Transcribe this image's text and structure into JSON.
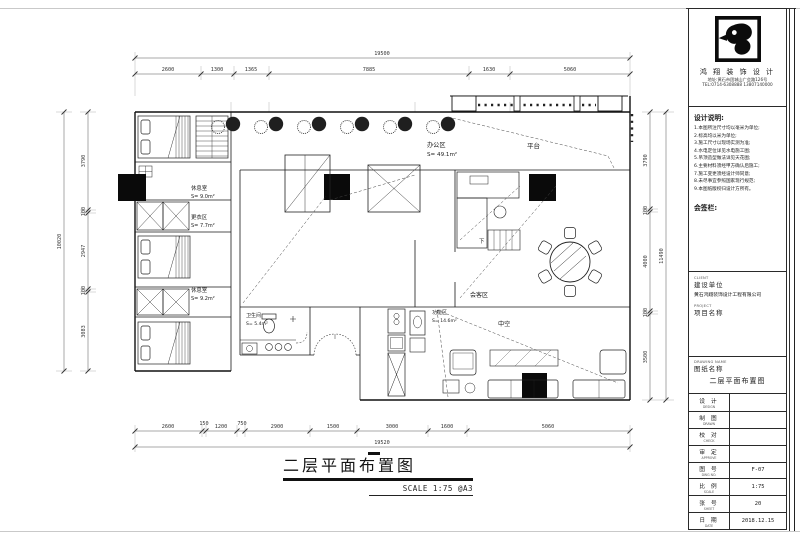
{
  "sheet": {
    "drawing_title": "二层平面布置图",
    "scale_note": "SCALE 1:75 @A3"
  },
  "dims": {
    "top_overall": "19500",
    "top_segments": [
      "2600",
      "1300",
      "1365",
      "7885",
      "1630",
      "5060"
    ],
    "bottom_segments": [
      "2600",
      "150",
      "1200",
      "750",
      "2900",
      "1500",
      "3000",
      "1600",
      "5060"
    ],
    "bottom_overall": "19520",
    "left_segments": [
      "3790",
      "100",
      "2947",
      "100",
      "3083"
    ],
    "left_overall": "10020",
    "right_segments": [
      "3790",
      "100",
      "4000",
      "100",
      "3500"
    ],
    "right_overall": "11490"
  },
  "plan_labels": {
    "dorm1_name": "休息室",
    "dorm1_area": "S= 9.0m²",
    "dorm2_name": "更衣区",
    "dorm2_area": "S= 7.7m²",
    "dorm3_name": "休息室",
    "dorm3_area": "S= 9.2m²",
    "main_name": "办公区",
    "main_area": "S= 49.1m²",
    "terrace": "平台",
    "meeting": "会客区",
    "void": "中空",
    "bath_name": "卫生间",
    "bath_area": "S= 5.4m²",
    "func_name": "功能区",
    "func_area": "S= 14.6m²",
    "stair_down": "下"
  },
  "title_block": {
    "company_name": "鸿 翔 装 饰 设 计",
    "company_line1": "地址:黄石市团城山广会路126号",
    "company_line2": "TEL:0714-6308888 13807140000",
    "notes_heading": "设计说明:",
    "notes": [
      "1.本图所注尺寸均以毫米为单位;",
      "2.标高均以米为单位;",
      "3.施工尺寸以现场实测为准;",
      "4.水电定位详见水电施工图;",
      "5.吊顶造型做法详见天花图;",
      "6.主要材料须经甲方确认后施工;",
      "7.施工变更须经设计师同意;",
      "8.未尽事宜参照国家现行规范;",
      "9.本图纸版权归设计方所有。"
    ],
    "sign_heading": "会签栏:",
    "fields": {
      "client_sub": "CLIENT",
      "client_label": "建设单位",
      "client_value": "黄石鸿翔装饰设计工程有限公司",
      "project_sub": "PROJECT",
      "project_label": "项目名称",
      "project_value": "",
      "drawing_sub": "DRAWING NAME",
      "drawing_label": "图纸名称",
      "drawing_value": "二层平面布置图"
    },
    "table": [
      {
        "label": "设 计",
        "sub": "DESIGN",
        "value": ""
      },
      {
        "label": "制 图",
        "sub": "DRAWN",
        "value": ""
      },
      {
        "label": "校 对",
        "sub": "CHECK",
        "value": ""
      },
      {
        "label": "审 定",
        "sub": "APPROVE",
        "value": ""
      },
      {
        "label": "图 号",
        "sub": "DWG NO.",
        "value": "F-07"
      },
      {
        "label": "比 例",
        "sub": "SCALE",
        "value": "1:75"
      },
      {
        "label": "张 号",
        "sub": "SHEET",
        "value": "20"
      },
      {
        "label": "日 期",
        "sub": "DATE",
        "value": "2018.12.15"
      }
    ]
  }
}
